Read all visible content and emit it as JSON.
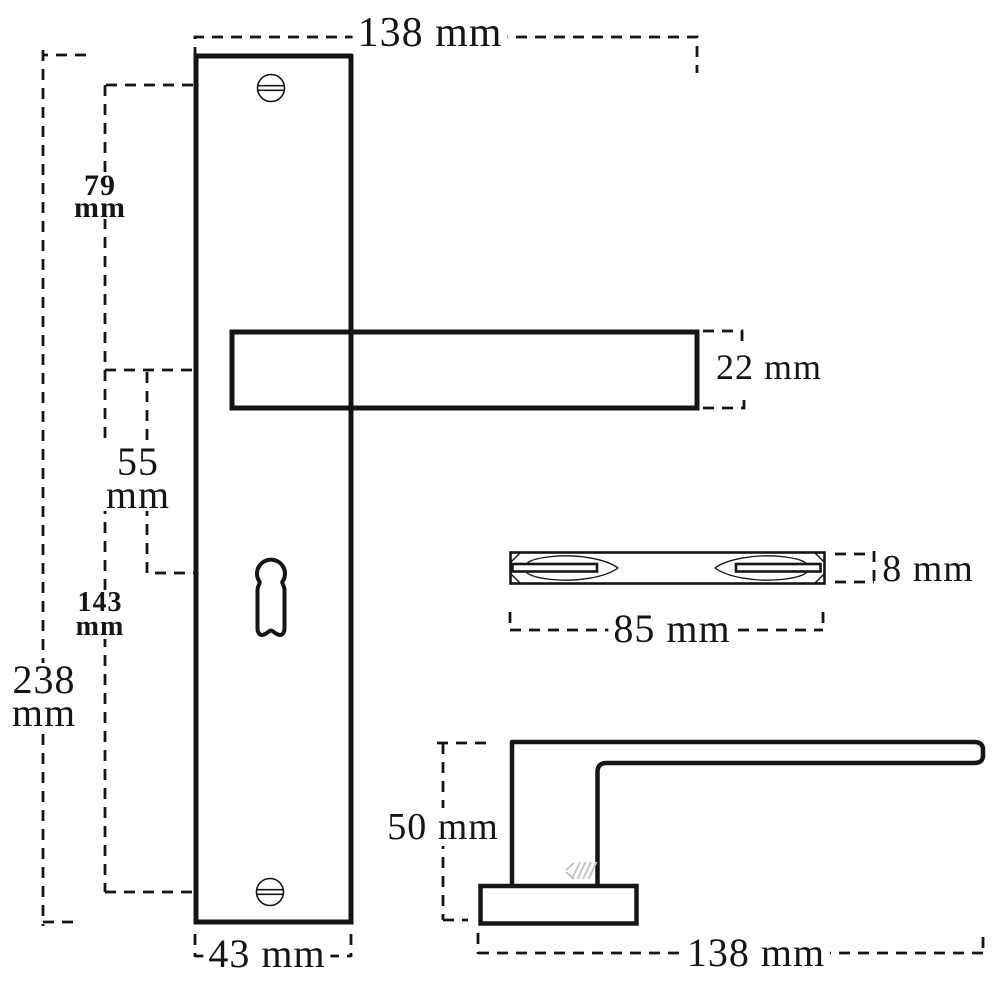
{
  "drawing": {
    "type": "technical-dimension-drawing",
    "subject": "door handle with long backplate, keyhole and lever",
    "unit": "mm",
    "colors": {
      "line": "#151515",
      "background": "#ffffff",
      "hatch": "#c4c4c4"
    },
    "dimensions": {
      "lever_length_top": "138 mm",
      "lever_thickness": "22 mm",
      "top_screw_to_lever": {
        "value": "79",
        "unit": "mm"
      },
      "lever_to_keyhole": {
        "value": "55",
        "unit": "mm"
      },
      "lever_to_bottom_screw": {
        "value": "143",
        "unit": "mm"
      },
      "plate_height": {
        "value": "238",
        "unit": "mm"
      },
      "plate_width": "43 mm",
      "profile_thickness": "8 mm",
      "profile_length": "85 mm",
      "handle_height_side": "50 mm",
      "handle_length_side": "138 mm"
    }
  }
}
